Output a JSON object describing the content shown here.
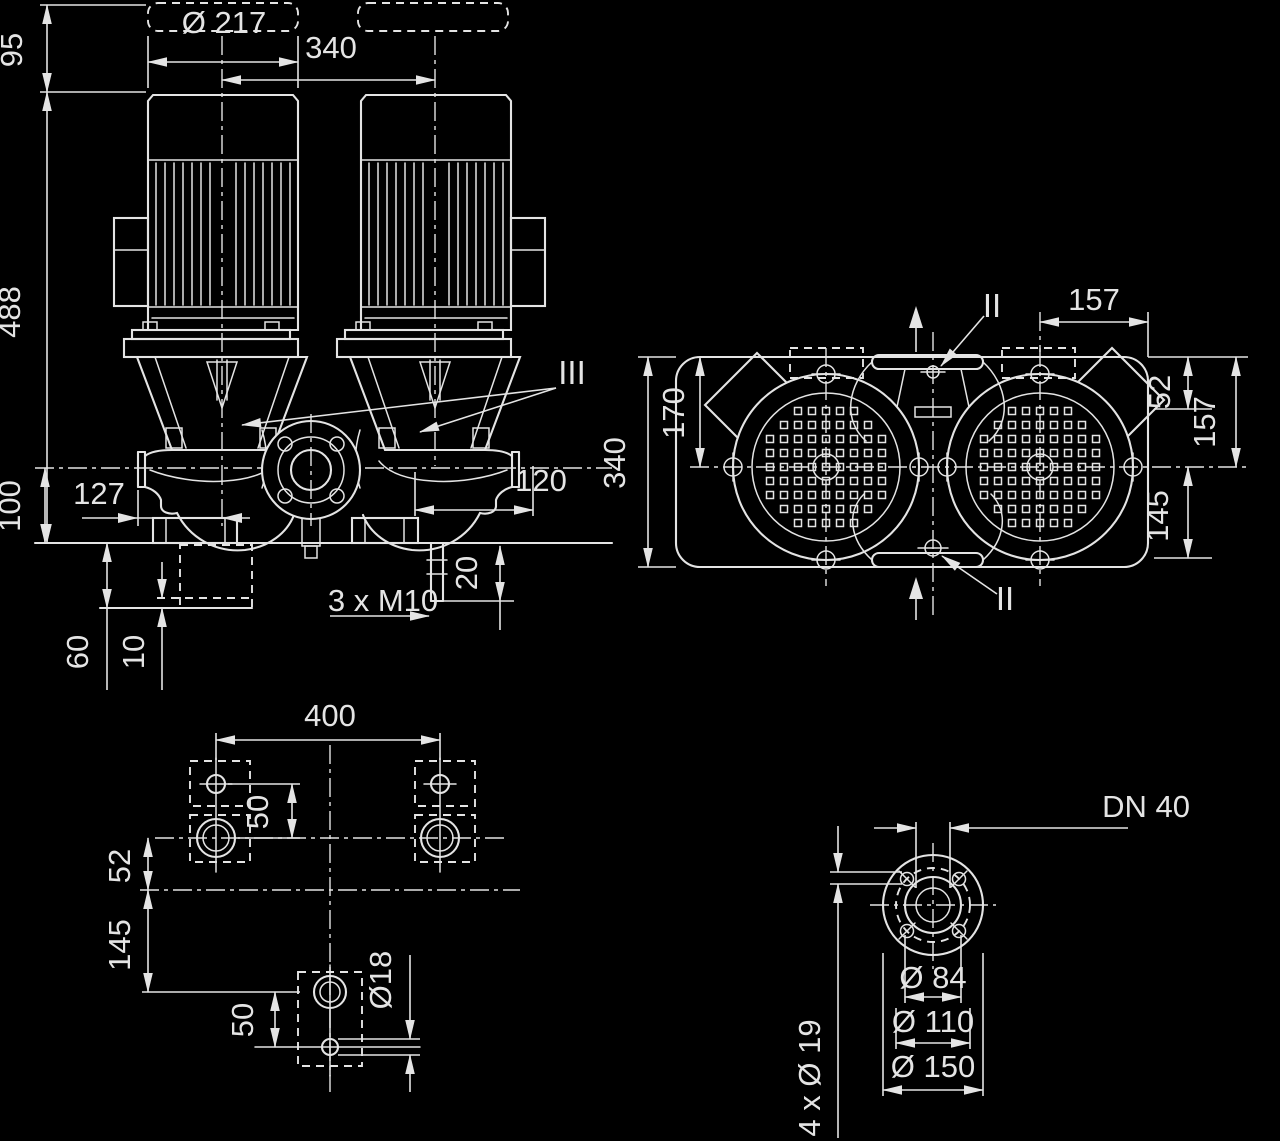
{
  "page": {
    "background": "#000000",
    "line_color": "#e4e4e4"
  },
  "drawing": {
    "type": "technical-dimensional-drawing",
    "subject": "Twin in-line pump dimensional drawing with four views",
    "views": [
      {
        "id": "front-view",
        "name": "front elevation with twin motors"
      },
      {
        "id": "top-view",
        "name": "plan view with fan covers and ports"
      },
      {
        "id": "foundation-plan-view",
        "name": "foundation bolt plan"
      },
      {
        "id": "flange-detail-view",
        "name": "DN 40 flange detail"
      }
    ],
    "labels": [
      {
        "id": "dia-217",
        "text": "Ø 217",
        "x": 224,
        "y": 33,
        "rot": 0,
        "size": 31
      },
      {
        "id": "len-340-top",
        "text": "340",
        "x": 331,
        "y": 58,
        "rot": 0,
        "size": 31
      },
      {
        "id": "h-95",
        "text": "95",
        "x": 22,
        "y": 50,
        "rot": -90,
        "size": 31
      },
      {
        "id": "h-488",
        "text": "488",
        "x": 20,
        "y": 312,
        "rot": -90,
        "size": 31
      },
      {
        "id": "h-100",
        "text": "100",
        "x": 20,
        "y": 506,
        "rot": -90,
        "size": 31
      },
      {
        "id": "w-127",
        "text": "127",
        "x": 99,
        "y": 504,
        "rot": 0,
        "size": 31
      },
      {
        "id": "w-120",
        "text": "120",
        "x": 541,
        "y": 491,
        "rot": 0,
        "size": 31
      },
      {
        "id": "thread",
        "text": "3 x M10",
        "x": 383,
        "y": 611,
        "rot": 0,
        "size": 31
      },
      {
        "id": "d-20",
        "text": "20",
        "x": 477,
        "y": 573,
        "rot": -90,
        "size": 31
      },
      {
        "id": "d-60",
        "text": "60",
        "x": 88,
        "y": 652,
        "rot": -90,
        "size": 31
      },
      {
        "id": "d-10",
        "text": "10",
        "x": 144,
        "y": 652,
        "rot": -90,
        "size": 31
      },
      {
        "id": "sec-III",
        "text": "III",
        "x": 572,
        "y": 384,
        "rot": 0,
        "size": 33
      },
      {
        "id": "sec-II-t",
        "text": "II",
        "x": 992,
        "y": 317,
        "rot": 0,
        "size": 33
      },
      {
        "id": "sec-II-b",
        "text": "II",
        "x": 1005,
        "y": 610,
        "rot": 0,
        "size": 33
      },
      {
        "id": "t-157-top",
        "text": "157",
        "x": 1094,
        "y": 310,
        "rot": 0,
        "size": 31
      },
      {
        "id": "t-52",
        "text": "52",
        "x": 1170,
        "y": 392,
        "rot": -90,
        "size": 31
      },
      {
        "id": "t-157-r",
        "text": "157",
        "x": 1215,
        "y": 422,
        "rot": -90,
        "size": 31
      },
      {
        "id": "t-145",
        "text": "145",
        "x": 1168,
        "y": 516,
        "rot": -90,
        "size": 31
      },
      {
        "id": "t-340",
        "text": "340",
        "x": 625,
        "y": 463,
        "rot": -90,
        "size": 31
      },
      {
        "id": "t-170",
        "text": "170",
        "x": 684,
        "y": 413,
        "rot": -90,
        "size": 31
      },
      {
        "id": "f-400",
        "text": "400",
        "x": 330,
        "y": 726,
        "rot": 0,
        "size": 31
      },
      {
        "id": "f-50-top",
        "text": "50",
        "x": 268,
        "y": 812,
        "rot": -90,
        "size": 31
      },
      {
        "id": "f-52",
        "text": "52",
        "x": 130,
        "y": 866,
        "rot": -90,
        "size": 31
      },
      {
        "id": "f-145",
        "text": "145",
        "x": 130,
        "y": 945,
        "rot": -90,
        "size": 31
      },
      {
        "id": "f-50-bot",
        "text": "50",
        "x": 253,
        "y": 1020,
        "rot": -90,
        "size": 31
      },
      {
        "id": "f-dia18",
        "text": "Ø18",
        "x": 391,
        "y": 980,
        "rot": -90,
        "size": 31
      },
      {
        "id": "dn40",
        "text": "DN 40",
        "x": 1146,
        "y": 817,
        "rot": 0,
        "size": 31
      },
      {
        "id": "bolt19",
        "text": "4 x Ø 19",
        "x": 820,
        "y": 1078,
        "rot": -90,
        "size": 31
      },
      {
        "id": "dia84",
        "text": "Ø 84",
        "x": 933,
        "y": 988,
        "rot": 0,
        "size": 31
      },
      {
        "id": "dia110",
        "text": "Ø 110",
        "x": 933,
        "y": 1032,
        "rot": 0,
        "size": 31
      },
      {
        "id": "dia150",
        "text": "Ø 150",
        "x": 933,
        "y": 1077,
        "rot": 0,
        "size": 31
      }
    ]
  }
}
